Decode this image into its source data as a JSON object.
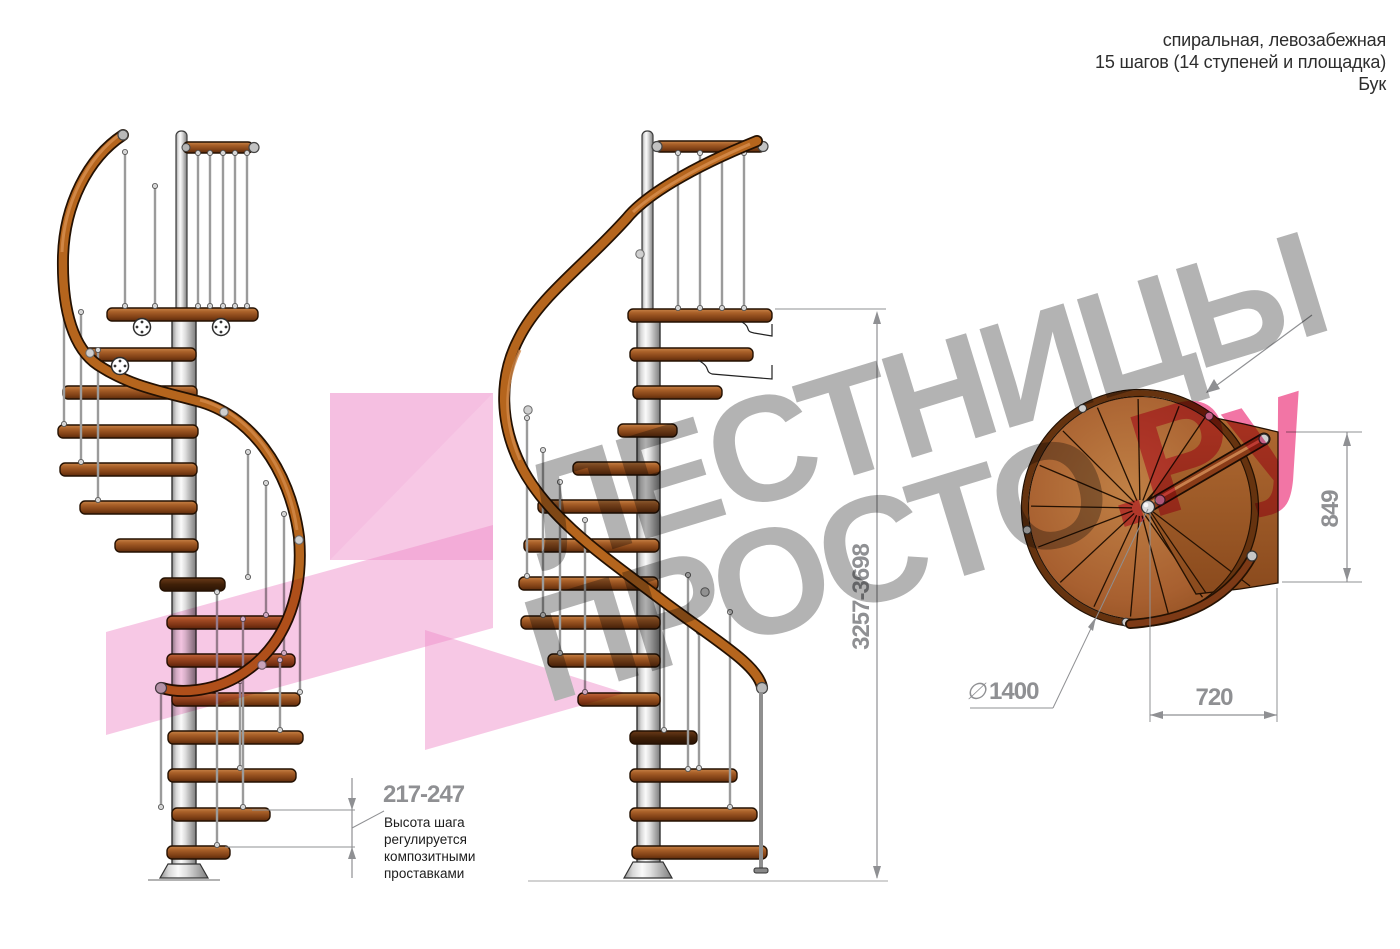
{
  "header": {
    "type": "спиральная, левозабежная",
    "steps": "15 шагов (14 ступеней и площадка)",
    "material": "Бук"
  },
  "watermark": {
    "word1": "ЛЕСТНИЦЫ",
    "word2": "ПРОСТО",
    "suffix": ".Ру"
  },
  "dimensions": {
    "total_height": "3257-3698",
    "step_height": "217-247",
    "step_note": "Высота шага\nрегулируется\nкомпозитными\nпроставками",
    "platform_depth": "849",
    "diameter_symbol": "∅",
    "diameter": "1400",
    "step_width": "720"
  },
  "colors": {
    "wood": "#a85f28",
    "wood_dark": "#3f2008",
    "rail": "#b5651d",
    "metal_pole": "#d9d9d9",
    "dimension_gray": "#8f9093",
    "watermark_gray": "#b3b3b3",
    "watermark_pink": "#f275a5",
    "ribbon_pink": "#ef92cb",
    "header_text": "#2d2d2d"
  }
}
